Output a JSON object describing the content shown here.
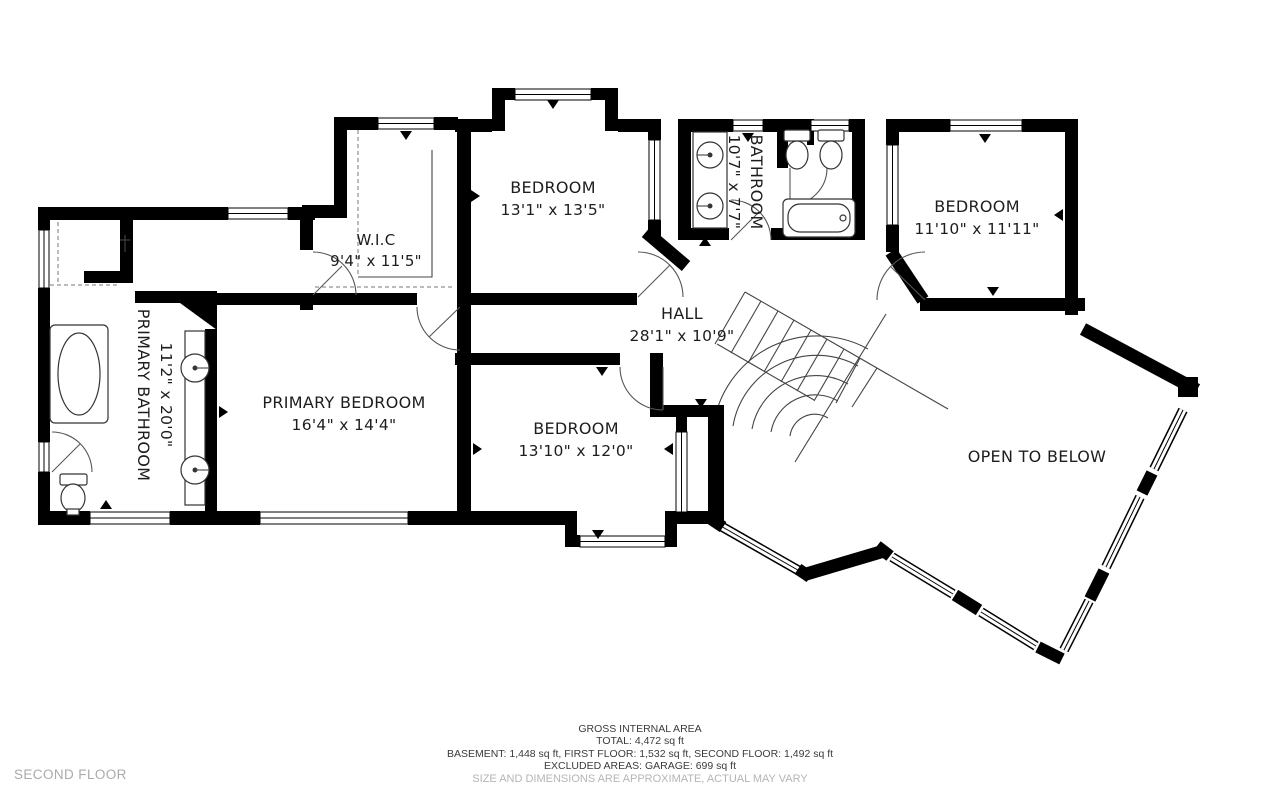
{
  "floor": {
    "name": "SECOND FLOOR"
  },
  "rooms": {
    "primary_bathroom": {
      "name": "PRIMARY BATHROOM",
      "dims": "11'2\" x 20'0\""
    },
    "primary_bedroom": {
      "name": "PRIMARY BEDROOM",
      "dims": "16'4\" x 14'4\""
    },
    "wic": {
      "name": "W.I.C",
      "dims": "9'4\" x 11'5\""
    },
    "bedroom_top": {
      "name": "BEDROOM",
      "dims": "13'1\" x 13'5\""
    },
    "bathroom": {
      "name": "BATHROOM",
      "dims": "10'7\" x 7'7\""
    },
    "bedroom_right": {
      "name": "BEDROOM",
      "dims": "11'10\" x 11'11\""
    },
    "hall": {
      "name": "HALL",
      "dims": "28'1\" x 10'9\""
    },
    "bedroom_bottom": {
      "name": "BEDROOM",
      "dims": "13'10\" x 12'0\""
    },
    "open_to_below": {
      "name": "OPEN TO BELOW"
    }
  },
  "footer": {
    "line1": "GROSS INTERNAL AREA",
    "line2": "TOTAL: 4,472 sq ft",
    "line3": "BASEMENT: 1,448 sq ft, FIRST FLOOR: 1,532 sq ft, SECOND FLOOR: 1,492 sq ft",
    "line4": "EXCLUDED AREAS: GARAGE: 699 sq ft",
    "line5": "SIZE AND DIMENSIONS ARE APPROXIMATE, ACTUAL MAY VARY"
  },
  "colors": {
    "wall": "#000000",
    "muted": "#b5b5b5",
    "text": "#1d1d1d"
  }
}
